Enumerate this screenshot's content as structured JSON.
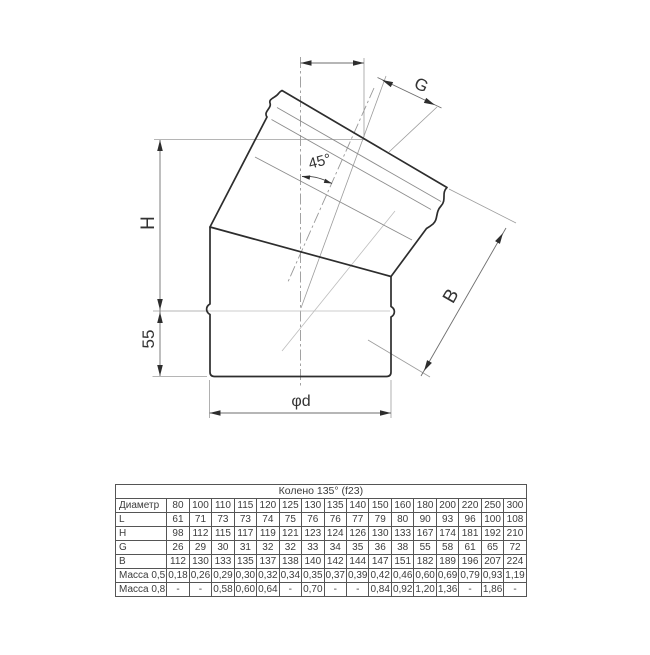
{
  "diagram": {
    "labels": {
      "g": "G",
      "angle": "45°",
      "h": "H",
      "bottom_socket": "55",
      "b": "B",
      "diameter": "φd"
    }
  },
  "table": {
    "title": "Колено 135° (f23)",
    "corner_label": "Диаметр",
    "columns": [
      "80",
      "100",
      "110",
      "115",
      "120",
      "125",
      "130",
      "135",
      "140",
      "150",
      "160",
      "180",
      "200",
      "220",
      "250",
      "300"
    ],
    "rows": [
      {
        "label": "L",
        "values": [
          "61",
          "71",
          "73",
          "73",
          "74",
          "75",
          "76",
          "76",
          "77",
          "79",
          "80",
          "90",
          "93",
          "96",
          "100",
          "108"
        ]
      },
      {
        "label": "H",
        "values": [
          "98",
          "112",
          "115",
          "117",
          "119",
          "121",
          "123",
          "124",
          "126",
          "130",
          "133",
          "167",
          "174",
          "181",
          "192",
          "210"
        ]
      },
      {
        "label": "G",
        "values": [
          "26",
          "29",
          "30",
          "31",
          "32",
          "32",
          "33",
          "34",
          "35",
          "36",
          "38",
          "55",
          "58",
          "61",
          "65",
          "72"
        ]
      },
      {
        "label": "B",
        "values": [
          "112",
          "130",
          "133",
          "135",
          "137",
          "138",
          "140",
          "142",
          "144",
          "147",
          "151",
          "182",
          "189",
          "196",
          "207",
          "224"
        ]
      },
      {
        "label": "Масса 0,5",
        "values": [
          "0,18",
          "0,26",
          "0,29",
          "0,30",
          "0,32",
          "0,34",
          "0,35",
          "0,37",
          "0,39",
          "0,42",
          "0,46",
          "0,60",
          "0,69",
          "0,79",
          "0,93",
          "1,19"
        ]
      },
      {
        "label": "Масса 0,8",
        "values": [
          "-",
          "-",
          "0,58",
          "0,60",
          "0,64",
          "-",
          "0,70",
          "-",
          "-",
          "0,84",
          "0,92",
          "1,20",
          "1,36",
          "-",
          "1,86",
          "-"
        ]
      }
    ]
  }
}
